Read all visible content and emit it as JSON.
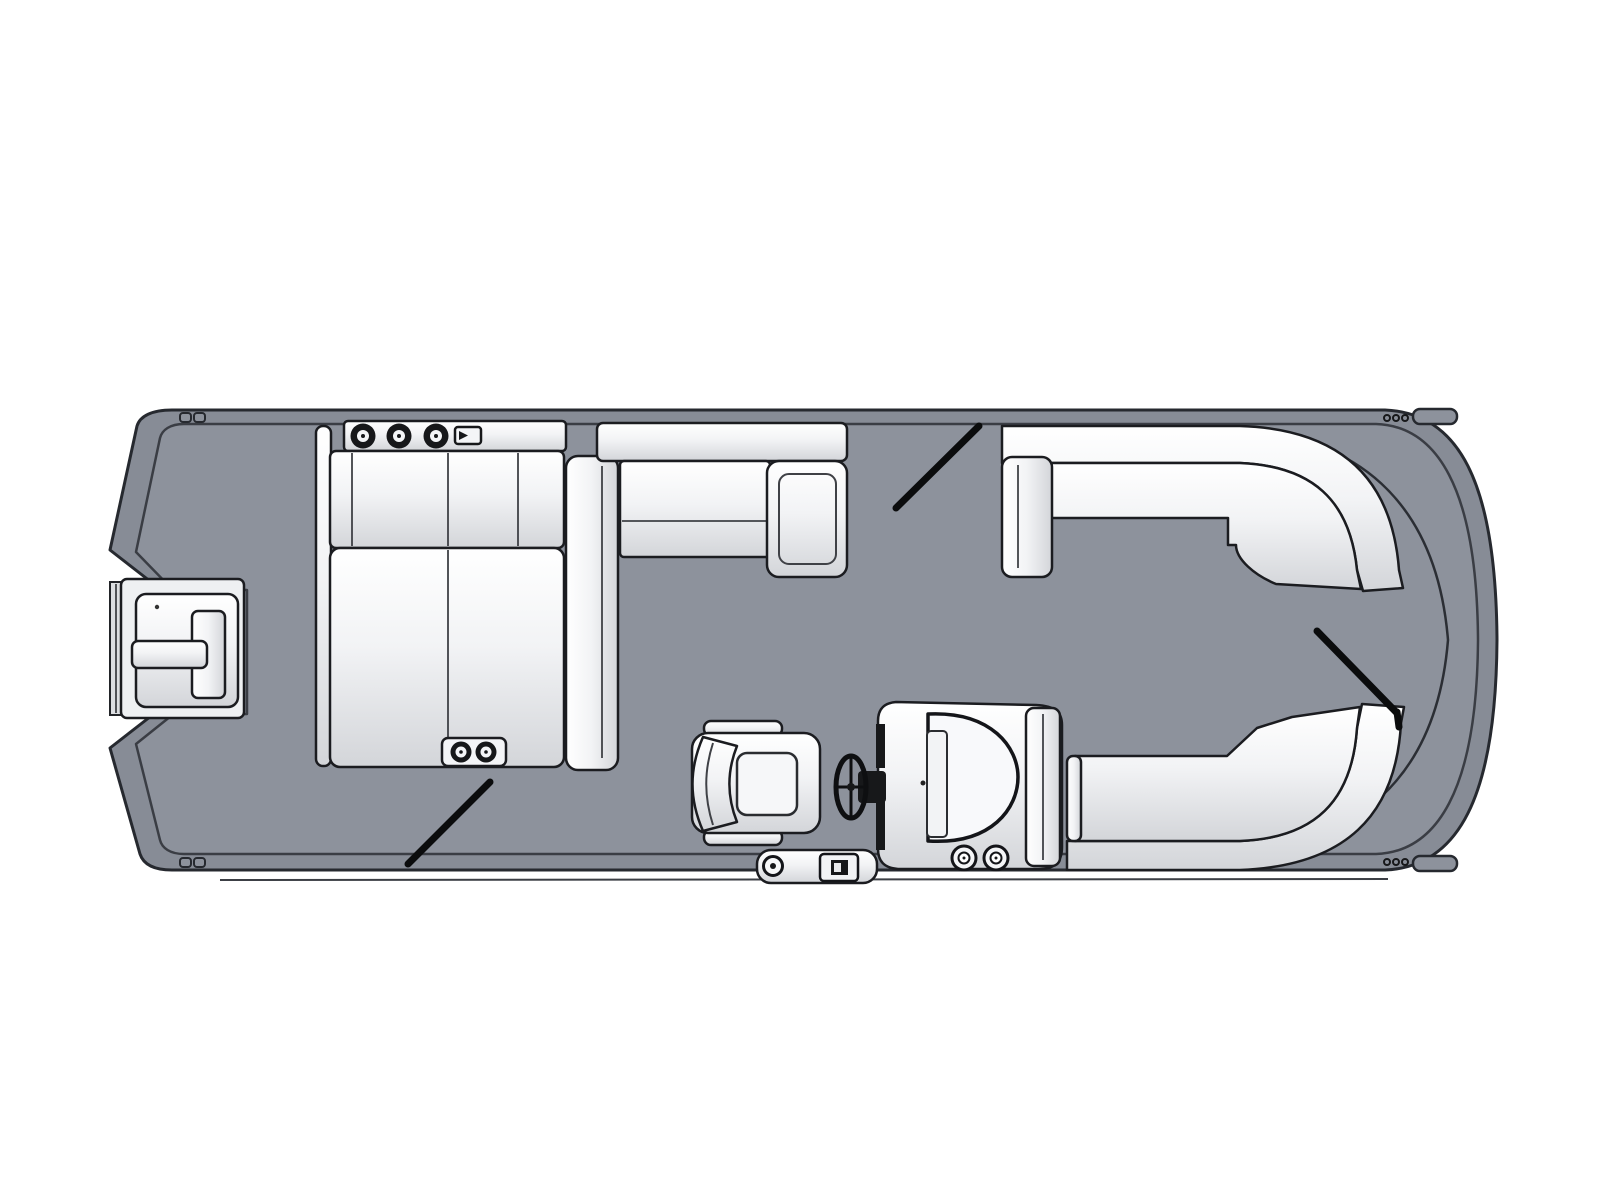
{
  "meta": {
    "title": "Pontoon boat deck floor plan (top view)",
    "diagram_type": "boat-floorplan",
    "orientation": "bow on the right, stern with outboard motor on the left",
    "background_color": "#ffffff"
  },
  "colors": {
    "background": "#ffffff",
    "hull_rail": "#878c96",
    "hull_outline": "#26292f",
    "deck": "#8d929c",
    "deck_outline": "#3a3d44",
    "cushion_light": "#ffffff",
    "cushion_mid": "#f2f3f5",
    "cushion_shadow": "#d3d5d9",
    "furniture_outline": "#1b1c20",
    "hardware_dark": "#17181a",
    "gate_line": "#0b0c0d"
  },
  "boat": {
    "hull": {
      "label": "pontoon deck with perimeter fence rail",
      "bow_shape": "rounded",
      "stern_feature": "motor notch"
    },
    "stern_motor": {
      "label": "outboard motor on transom bracket",
      "position": "stern (left)"
    },
    "gates": [
      {
        "name": "stern starboard gate swing line"
      },
      {
        "name": "port midship gate swing line"
      },
      {
        "name": "bow gate swing line"
      }
    ],
    "furniture": [
      {
        "name": "port stern L-lounge",
        "features": [
          "top shelf with 3 speaker knobs",
          "latch fitting",
          "4 back cushions",
          "large sun pad",
          "2 cup holders",
          "chaise seat column"
        ]
      },
      {
        "name": "port midship bench",
        "features": [
          "backrest",
          "seat with seam",
          "chaise end cushion"
        ]
      },
      {
        "name": "port bow wrap-around lounge",
        "features": [
          "armrest",
          "curved corner seat"
        ]
      },
      {
        "name": "starboard bow wrap-around lounge",
        "features": [
          "curved corner seat",
          "end lip"
        ]
      },
      {
        "name": "helm console",
        "features": [
          "windshield arch",
          "instrument panel",
          "throttle",
          "2 cup holders",
          "side panel"
        ]
      },
      {
        "name": "captain's chair",
        "features": [
          "two armrests",
          "wrap backrest",
          "seat cushion"
        ]
      },
      {
        "name": "steering wheel"
      },
      {
        "name": "boarding gate door",
        "features": [
          "hinge",
          "latch"
        ]
      }
    ],
    "hardware": {
      "corner_cleats": 2,
      "corner_hinge_dots": 6,
      "corner_caps": 2
    }
  }
}
